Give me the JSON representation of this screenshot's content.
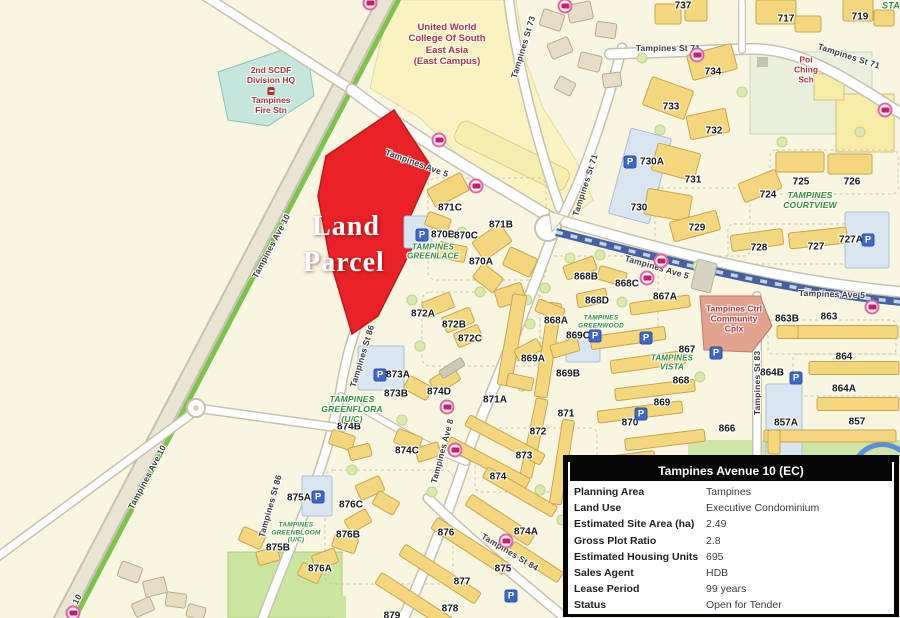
{
  "map": {
    "parcel_label": {
      "lines": [
        "Land",
        "Parcel"
      ]
    },
    "blocks": [
      {
        "t": "737",
        "x": 683,
        "y": 6
      },
      {
        "t": "717",
        "x": 786,
        "y": 19
      },
      {
        "t": "719",
        "x": 860,
        "y": 17
      },
      {
        "t": "734",
        "x": 713,
        "y": 72
      },
      {
        "t": "733",
        "x": 671,
        "y": 107
      },
      {
        "t": "732",
        "x": 714,
        "y": 131
      },
      {
        "t": "731",
        "x": 693,
        "y": 180
      },
      {
        "t": "730A",
        "x": 652,
        "y": 162
      },
      {
        "t": "730",
        "x": 639,
        "y": 208
      },
      {
        "t": "729",
        "x": 697,
        "y": 228
      },
      {
        "t": "725",
        "x": 801,
        "y": 182
      },
      {
        "t": "726",
        "x": 852,
        "y": 182
      },
      {
        "t": "724",
        "x": 768,
        "y": 195
      },
      {
        "t": "728",
        "x": 759,
        "y": 248
      },
      {
        "t": "727",
        "x": 816,
        "y": 247
      },
      {
        "t": "727A",
        "x": 851,
        "y": 240
      },
      {
        "t": "871C",
        "x": 450,
        "y": 208
      },
      {
        "t": "871B",
        "x": 501,
        "y": 225
      },
      {
        "t": "870B",
        "x": 443,
        "y": 235
      },
      {
        "t": "870C",
        "x": 466,
        "y": 236
      },
      {
        "t": "870A",
        "x": 481,
        "y": 262
      },
      {
        "t": "868B",
        "x": 586,
        "y": 277
      },
      {
        "t": "868C",
        "x": 627,
        "y": 284
      },
      {
        "t": "868D",
        "x": 597,
        "y": 301
      },
      {
        "t": "868A",
        "x": 556,
        "y": 321
      },
      {
        "t": "867A",
        "x": 665,
        "y": 297
      },
      {
        "t": "869C",
        "x": 578,
        "y": 336
      },
      {
        "t": "869A",
        "x": 533,
        "y": 359
      },
      {
        "t": "869B",
        "x": 568,
        "y": 374
      },
      {
        "t": "867",
        "x": 687,
        "y": 350
      },
      {
        "t": "868",
        "x": 681,
        "y": 381
      },
      {
        "t": "869",
        "x": 662,
        "y": 403
      },
      {
        "t": "871",
        "x": 566,
        "y": 414
      },
      {
        "t": "870",
        "x": 630,
        "y": 423
      },
      {
        "t": "866",
        "x": 727,
        "y": 429
      },
      {
        "t": "863B",
        "x": 787,
        "y": 319
      },
      {
        "t": "863",
        "x": 829,
        "y": 317
      },
      {
        "t": "864",
        "x": 844,
        "y": 357
      },
      {
        "t": "864B",
        "x": 772,
        "y": 373
      },
      {
        "t": "864A",
        "x": 844,
        "y": 389
      },
      {
        "t": "857A",
        "x": 786,
        "y": 423
      },
      {
        "t": "857",
        "x": 857,
        "y": 422
      },
      {
        "t": "872A",
        "x": 423,
        "y": 314
      },
      {
        "t": "872B",
        "x": 454,
        "y": 325
      },
      {
        "t": "872C",
        "x": 470,
        "y": 339
      },
      {
        "t": "873A",
        "x": 398,
        "y": 375
      },
      {
        "t": "873B",
        "x": 396,
        "y": 394
      },
      {
        "t": "874D",
        "x": 439,
        "y": 392
      },
      {
        "t": "874B",
        "x": 349,
        "y": 427
      },
      {
        "t": "874C",
        "x": 407,
        "y": 451
      },
      {
        "t": "871A",
        "x": 495,
        "y": 400
      },
      {
        "t": "872",
        "x": 538,
        "y": 432
      },
      {
        "t": "873",
        "x": 524,
        "y": 456
      },
      {
        "t": "874",
        "x": 498,
        "y": 477
      },
      {
        "t": "874A",
        "x": 526,
        "y": 532
      },
      {
        "t": "875A",
        "x": 299,
        "y": 498
      },
      {
        "t": "876C",
        "x": 351,
        "y": 505
      },
      {
        "t": "876B",
        "x": 348,
        "y": 535
      },
      {
        "t": "875B",
        "x": 278,
        "y": 548
      },
      {
        "t": "876A",
        "x": 320,
        "y": 569
      },
      {
        "t": "876",
        "x": 446,
        "y": 533
      },
      {
        "t": "875",
        "x": 503,
        "y": 569
      },
      {
        "t": "877",
        "x": 462,
        "y": 582
      },
      {
        "t": "878",
        "x": 450,
        "y": 609
      },
      {
        "t": "879",
        "x": 392,
        "y": 616
      }
    ],
    "streets": [
      {
        "t": "Tampines Ave 10",
        "x": 271,
        "y": 246,
        "r": -62
      },
      {
        "t": "Tampines Ave 10",
        "x": 147,
        "y": 477,
        "r": -62
      },
      {
        "t": "10",
        "x": 77,
        "y": 599,
        "r": -62
      },
      {
        "t": "Tampines Ave 5",
        "x": 417,
        "y": 163,
        "r": 20
      },
      {
        "t": "Tampines Ave 5",
        "x": 657,
        "y": 267,
        "r": 16
      },
      {
        "t": "Tampines Ave 5",
        "x": 832,
        "y": 294,
        "r": 2
      },
      {
        "t": "Tampines St 73",
        "x": 523,
        "y": 47,
        "r": -73
      },
      {
        "t": "Tampines St 71",
        "x": 668,
        "y": 48,
        "r": 0
      },
      {
        "t": "Tampines St 71",
        "x": 849,
        "y": 56,
        "r": 18
      },
      {
        "t": "Tampines St 71",
        "x": 585,
        "y": 185,
        "r": -72
      },
      {
        "t": "Tampines St 86",
        "x": 362,
        "y": 356,
        "r": -73
      },
      {
        "t": "Tampines St 86",
        "x": 270,
        "y": 506,
        "r": -74
      },
      {
        "t": "Tampines Ave 8",
        "x": 442,
        "y": 451,
        "r": -75
      },
      {
        "t": "Tampines St 84",
        "x": 510,
        "y": 552,
        "r": 31
      },
      {
        "t": "Tampines St 83",
        "x": 757,
        "y": 383,
        "r": -90
      }
    ],
    "estates": [
      {
        "lines": [
          "TAMPINES",
          "GREENLACE"
        ],
        "x": 433,
        "y": 252,
        "s": 8
      },
      {
        "lines": [
          "TAMPINES",
          "GREENWOOD"
        ],
        "x": 601,
        "y": 322,
        "s": 6.5
      },
      {
        "lines": [
          "TAMPINES",
          "VISTA"
        ],
        "x": 672,
        "y": 363,
        "s": 8
      },
      {
        "lines": [
          "TAMPINES",
          "COURTVIEW"
        ],
        "x": 810,
        "y": 200,
        "s": 8.5
      },
      {
        "lines": [
          "TAMPINES",
          "GREENFLORA",
          "(U/C)"
        ],
        "x": 352,
        "y": 409,
        "s": 8.5
      },
      {
        "lines": [
          "TAMPINES",
          "GREENBLOOM",
          "(U/C)"
        ],
        "x": 296,
        "y": 533,
        "s": 6.5
      },
      {
        "lines": [
          "STA"
        ],
        "x": 891,
        "y": 6,
        "s": 9
      }
    ],
    "landmarks": [
      {
        "lines": [
          "United World",
          "College Of South",
          "East Asia",
          "(East Campus)"
        ],
        "x": 447,
        "y": 45,
        "s": 9.5
      },
      {
        "lines": [
          "2nd SCDF",
          "Division HQ"
        ],
        "x": 271,
        "y": 75,
        "s": 8.5
      },
      {
        "lines": [
          "Tampines",
          "Fire Stn"
        ],
        "x": 271,
        "y": 105,
        "s": 8.5
      },
      {
        "lines": [
          "Poi",
          "Ching",
          "Sch"
        ],
        "x": 806,
        "y": 70,
        "s": 8.5
      },
      {
        "lines": [
          "Tampines Ctrl",
          "Community",
          "Cplx"
        ],
        "x": 734,
        "y": 319,
        "s": 8.5
      }
    ],
    "icons": {
      "parking": [
        [
          630,
          162
        ],
        [
          868,
          240
        ],
        [
          796,
          378
        ],
        [
          380,
          375
        ],
        [
          318,
          497
        ],
        [
          422,
          235
        ],
        [
          595,
          336
        ],
        [
          646,
          338
        ],
        [
          716,
          353
        ],
        [
          641,
          414
        ],
        [
          511,
          596
        ]
      ],
      "bus_stop": [
        [
          370,
          3
        ],
        [
          565,
          6
        ],
        [
          697,
          55
        ],
        [
          885,
          110
        ],
        [
          439,
          140
        ],
        [
          476,
          186
        ],
        [
          661,
          261
        ],
        [
          647,
          278
        ],
        [
          872,
          307
        ],
        [
          447,
          407
        ],
        [
          455,
          450
        ],
        [
          506,
          541
        ],
        [
          73,
          613
        ]
      ],
      "fire_station": [
        [
          271,
          91
        ]
      ]
    }
  },
  "info_table": {
    "title": "Tampines Avenue 10 (EC)",
    "rows": [
      {
        "label": "Planning Area",
        "value": "Tampines"
      },
      {
        "label": "Land Use",
        "value": "Executive Condominium"
      },
      {
        "label": "Estimated Site Area (ha)",
        "value": "2.49"
      },
      {
        "label": "Gross Plot Ratio",
        "value": "2.8"
      },
      {
        "label": "Estimated Housing Units",
        "value": "695"
      },
      {
        "label": "Sales Agent",
        "value": "HDB"
      },
      {
        "label": "Lease Period",
        "value": "99 years"
      },
      {
        "label": "Status",
        "value": "Open for Tender"
      }
    ]
  },
  "colors": {
    "parcel_red": "#EA2127",
    "estate_green": "#2E8F35",
    "landmark_red": "#B23237",
    "hdb_yellow": "#F4D77C",
    "mrt_blue": "#46619F",
    "road_green_strip": "#7CC24D"
  }
}
